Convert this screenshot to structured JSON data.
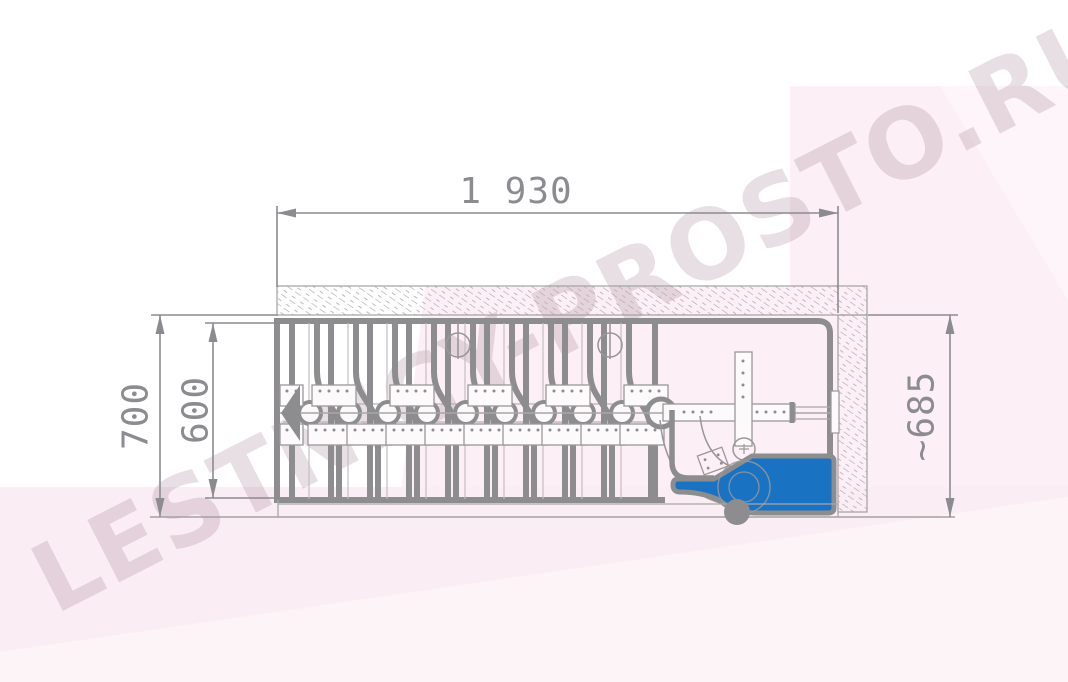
{
  "watermark": {
    "text": "LESTNICY-PROSTO.RU"
  },
  "dimensions": {
    "top_width": "1 930",
    "left_outer_height": "700",
    "left_inner_height": "600",
    "right_height": "~685"
  },
  "colors": {
    "handle_blue": "#1a73c2",
    "line_gray": "#8d8d8f",
    "dim_gray": "#8b8b90",
    "pink_bg": "#faeef4"
  }
}
